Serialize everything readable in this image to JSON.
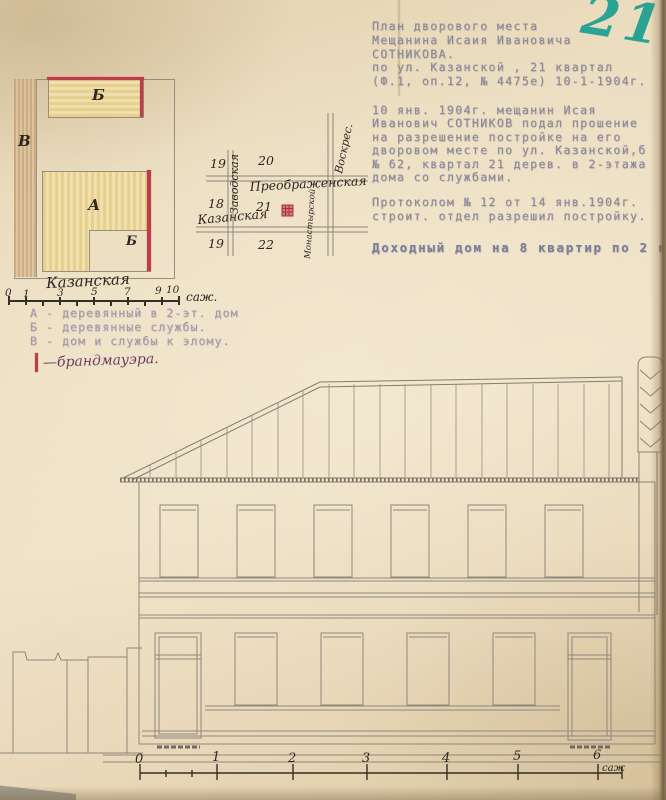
{
  "page_number": "21",
  "typed_note": {
    "header": [
      "План дворового места",
      "Мещанина Исаия Ивановича",
      "СОТНИКОВА.",
      "по ул. Казанской , 21 квартал",
      "(Ф.1, оп.12, № 4475е) 10-1-1904г."
    ],
    "body": [
      "10 янв. 1904г. мещанин Исая",
      "Иванович СОТНИКОВ подал прошение",
      "на разрешение постройке на его",
      "дворовом месте по ул. Казанской,б",
      "№ 62, квартал 21 дерев. в 2-этажа",
      "дома со службами."
    ],
    "protocol": [
      "Протоколом № 12 от 14 янв.1904г.",
      "строит. отдел разрешил постройку."
    ],
    "summary": "Доходный дом на 8 квартир по 2 км"
  },
  "site_plan": {
    "labels": {
      "strip": "В",
      "top_building": "Б",
      "main_building": "А",
      "small_building": "Б"
    },
    "street_label": "Казанская",
    "scale": {
      "numbers": [
        "0",
        "1",
        "3",
        "5",
        "7",
        "9",
        "10"
      ],
      "unit": "саж."
    }
  },
  "legend": {
    "items": [
      "А - деревянный в 2-эт. дом",
      "Б - деревянные службы.",
      "В - дом и службы к элому."
    ],
    "handwritten": "—брандмауэра."
  },
  "sketch": {
    "streets": {
      "left_vertical": "Заводская",
      "right_top": "Воскрес.",
      "right_bottom": "Монастырской",
      "middle_horizontal": "Преображенская",
      "bottom_horizontal": "Казанская"
    },
    "blocks": [
      "19",
      "20",
      "18",
      "21",
      "19",
      "22"
    ]
  },
  "facade_scale": {
    "numbers": [
      "0",
      "1",
      "2",
      "3",
      "4",
      "5",
      "6"
    ],
    "unit": "саж"
  },
  "colors": {
    "paper": "#ead9bb",
    "accent_red": "#c03b4a",
    "plan_yellow": "#e7cf8e",
    "plan_brown": "#c9a87e",
    "ink_green": "#2aa394",
    "typed_text": "#8e8b9b",
    "pencil": "#8f887c",
    "ink": "#332e27"
  }
}
